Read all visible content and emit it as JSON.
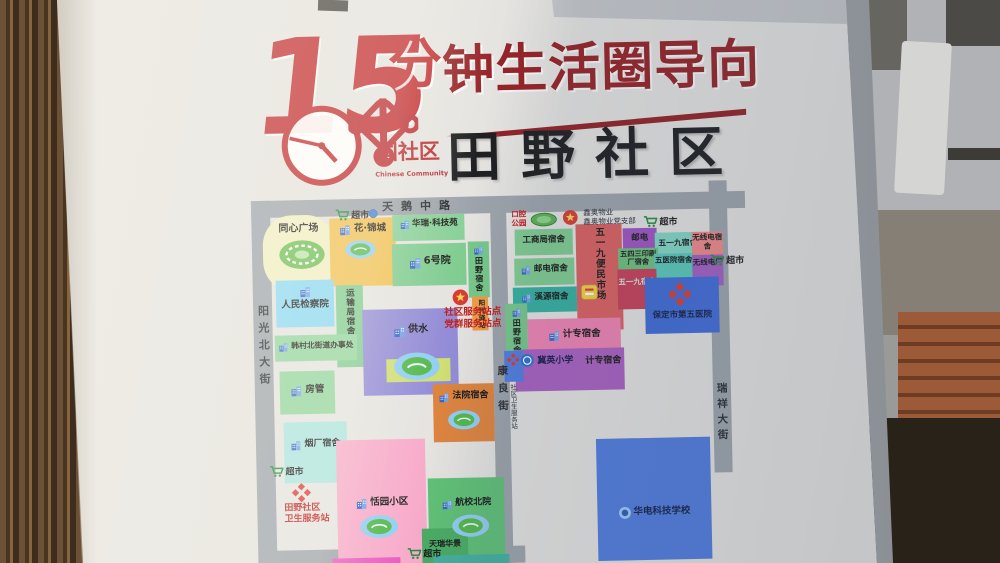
{
  "header": {
    "title_number": "15",
    "title_fen": "分",
    "title_rest": "钟生活圈导向",
    "logo_text": "国社区",
    "logo_subtext": "Chinese Community",
    "community_name": "田野社区"
  },
  "colors": {
    "title_red": "#bf2428",
    "title_maroon": "#931c20",
    "annotation_red": "#c01818",
    "road_gray": "#9aa1a9"
  },
  "map": {
    "roads": [
      {
        "id": "tiane-middle-road",
        "x": 253,
        "y": 196,
        "w": 494,
        "h": 17
      },
      {
        "id": "yangguang-north-street-road",
        "x": 253,
        "y": 196,
        "w": 19,
        "h": 367
      },
      {
        "id": "kangliang-street-road",
        "x": 492,
        "y": 207,
        "w": 16,
        "h": 356
      },
      {
        "id": "ruixiang-street-road",
        "x": 711,
        "y": 185,
        "w": 18,
        "h": 292
      },
      {
        "id": "south-road",
        "x": 258,
        "y": 546,
        "w": 262,
        "h": 17
      }
    ],
    "road_labels": [
      {
        "id": "tiane-middle-road-label",
        "t": "天鹅中路",
        "x": 384,
        "y": 198,
        "fs": 11,
        "ls": 8
      },
      {
        "id": "yangguang-north-street-label",
        "t": "阳光北大街",
        "x": 256,
        "y": 300,
        "fs": 11,
        "ls": 6,
        "v": 1
      },
      {
        "id": "kangliang-street-label",
        "t": "康良街",
        "x": 494,
        "y": 365,
        "fs": 10.5,
        "ls": 7,
        "v": 1
      },
      {
        "id": "ruixiang-street-label",
        "t": "瑞祥大街",
        "x": 713,
        "y": 387,
        "fs": 10.5,
        "ls": 5,
        "v": 1
      }
    ],
    "areas": [
      {
        "id": "tongxin-square",
        "t": "同心广场",
        "x": 264,
        "y": 211,
        "w": 72,
        "h": 76,
        "bg": "#f0eec2",
        "fs": 10,
        "ly": 8,
        "round": 40
      },
      {
        "id": "hua-jincheng",
        "t": "花·锦城",
        "x": 331,
        "y": 215,
        "w": 66,
        "h": 68,
        "bg": "#f0bf4e",
        "fs": 9.5,
        "icon": "building",
        "ly": 5
      },
      {
        "id": "huarui-tech-park",
        "t": "华瑞·科技苑",
        "x": 394,
        "y": 213,
        "w": 72,
        "h": 26,
        "bg": "#85cf96",
        "fs": 8.5,
        "icon": "building",
        "ly": 4
      },
      {
        "id": "no6-yard",
        "t": "6号院",
        "x": 393,
        "y": 242,
        "w": 74,
        "h": 42,
        "bg": "#7ccb8e",
        "fs": 10,
        "icon": "building",
        "ly": 12
      },
      {
        "id": "tianye-dorm-west",
        "t": "田野宿舍",
        "x": 469,
        "y": 241,
        "w": 21,
        "h": 56,
        "bg": "#72c787",
        "fs": 8,
        "icon": "building",
        "v": 1
      },
      {
        "id": "peoples-procuratorate",
        "t": "人民检察院",
        "x": 276,
        "y": 276,
        "w": 58,
        "h": 47,
        "bg": "#86d8f4",
        "fs": 9.5,
        "icon": "building",
        "col": 1,
        "ly": 5
      },
      {
        "id": "transport-bureau-dorm",
        "t": "运输局宿舍",
        "x": 336,
        "y": 282,
        "w": 27,
        "h": 82,
        "bg": "#7ccb8e",
        "fs": 8.5,
        "v": 1
      },
      {
        "id": "water-supply",
        "t": "供水",
        "x": 362,
        "y": 307,
        "w": 95,
        "h": 86,
        "bg": "#9089d6",
        "fs": 10,
        "icon": "building",
        "ly": 15
      },
      {
        "id": "hancun-north-street-office",
        "t": "韩村北街道办事处",
        "x": 274,
        "y": 331,
        "w": 82,
        "h": 26,
        "bg": "#8fd49b",
        "fs": 7.8,
        "icon": "building",
        "ly": 6
      },
      {
        "id": "housing-authority",
        "t": "房管",
        "x": 278,
        "y": 367,
        "w": 55,
        "h": 43,
        "bg": "#8fd49b",
        "fs": 9.5,
        "icon": "building",
        "ly": 13
      },
      {
        "id": "design-institute",
        "t": "设计院",
        "x": 385,
        "y": 357,
        "w": 64,
        "h": 23,
        "bg": "#cfdd70",
        "fs": 9,
        "icon": "building",
        "ly": 3
      },
      {
        "id": "court-dorm",
        "t": "法院宿舍",
        "x": 431,
        "y": 383,
        "w": 61,
        "h": 58,
        "bg": "#dd8038",
        "fs": 9,
        "icon": "building",
        "ly": 7
      },
      {
        "id": "tobacco-factory-dorm",
        "t": "烟厂宿舍",
        "x": 281,
        "y": 418,
        "w": 63,
        "h": 61,
        "bg": "#a8e4de",
        "fs": 9,
        "icon": "building",
        "ly": 17
      },
      {
        "id": "tianyuan-community",
        "t": "恬园小区",
        "x": 333,
        "y": 437,
        "w": 89,
        "h": 125,
        "bg": "#f7a9c9",
        "fs": 9.5,
        "icon": "building",
        "ly": 57
      },
      {
        "id": "hangxiao-north-yard",
        "t": "航校北院",
        "x": 424,
        "y": 477,
        "w": 76,
        "h": 86,
        "bg": "#5bbf72",
        "fs": 9,
        "icon": "building",
        "ly": 20
      },
      {
        "id": "tianrui-huajing",
        "t": "天瑞华景",
        "x": 417,
        "y": 527,
        "w": 46,
        "h": 35,
        "bg": "#45aa60",
        "fs": 8,
        "ly": 11
      },
      {
        "id": "gongshang-bureau-dorm",
        "t": "工商局宿舍",
        "x": 516,
        "y": 230,
        "w": 58,
        "h": 26,
        "bg": "#7ccb8e",
        "fs": 8.5,
        "ly": 6
      },
      {
        "id": "post-telecom-dorm",
        "t": "邮电宿舍",
        "x": 515,
        "y": 259,
        "w": 60,
        "h": 27,
        "bg": "#7ccb8e",
        "fs": 8.5,
        "icon": "building",
        "ly": 6
      },
      {
        "id": "xiyuan-dorm",
        "t": "溪源宿舍",
        "x": 513,
        "y": 288,
        "w": 64,
        "h": 25,
        "bg": "#2fae9e",
        "fs": 8.5,
        "icon": "building",
        "ly": 5
      },
      {
        "id": "wuyijiu-market",
        "t": "五一九便民市场",
        "x": 577,
        "y": 226,
        "w": 46,
        "h": 106,
        "bg": "#d95b5b",
        "fs": 9.5,
        "v": 1
      },
      {
        "id": "post-telecom",
        "t": "邮电",
        "x": 624,
        "y": 231,
        "w": 34,
        "h": 25,
        "bg": "#9c4fc0",
        "fs": 8.5,
        "ly": 5
      },
      {
        "id": "wuyijiu-dorm",
        "t": "五一九宿舍",
        "x": 656,
        "y": 236,
        "w": 46,
        "h": 24,
        "bg": "#7fd6c4",
        "fs": 7.8,
        "ly": 6
      },
      {
        "id": "radio-dorm",
        "t": "无线电宿舍",
        "x": 693,
        "y": 236,
        "w": 31,
        "h": 33,
        "bg": "#ef8585",
        "fs": 7.5,
        "ly": 2
      },
      {
        "id": "wusansan-print-dorm",
        "t": "五四三印刷厂宿舍",
        "x": 619,
        "y": 251,
        "w": 40,
        "h": 38,
        "bg": "#6abf7a",
        "fs": 7.2,
        "ly": 2
      },
      {
        "id": "fifth-hospital-dorm",
        "t": "五医院宿舍",
        "x": 655,
        "y": 257,
        "w": 39,
        "h": 29,
        "bg": "#55c8b8",
        "fs": 7.5,
        "ly": 3
      },
      {
        "id": "radio-factory",
        "t": "无线电厂",
        "x": 693,
        "y": 259,
        "w": 31,
        "h": 31,
        "bg": "#a05ac2",
        "fs": 7.5,
        "ly": 4
      },
      {
        "id": "wuyijiu-dorm-2",
        "t": "五一九宿舍",
        "x": 618,
        "y": 272,
        "w": 39,
        "h": 40,
        "bg": "#c43a52",
        "fs": 7.5,
        "c": "#cdeedd",
        "ly": 9
      },
      {
        "id": "baoding-fifth-hospital",
        "t": "保定市第五医院",
        "x": 645,
        "y": 281,
        "w": 74,
        "h": 56,
        "bg": "#3a66d6",
        "fs": 8.5,
        "c": "#0e1b42",
        "ly": 33
      },
      {
        "id": "tianye-dorm-east",
        "t": "田野宿舍",
        "x": 505,
        "y": 304,
        "w": 22,
        "h": 48,
        "bg": "#72c787",
        "fs": 8,
        "icon": "building",
        "v": 1
      },
      {
        "id": "jizhuan-dorm",
        "t": "计专宿舍",
        "x": 527,
        "y": 320,
        "w": 93,
        "h": 37,
        "bg": "#ef7fb2",
        "fs": 9.5,
        "icon": "building",
        "ly": 10
      },
      {
        "id": "jiying-primary-school",
        "t": "",
        "x": 514,
        "y": 350,
        "w": 109,
        "h": 42,
        "bg": "#a65bbf"
      },
      {
        "id": "clinic-point",
        "t": "",
        "x": 503,
        "y": 351,
        "w": 19,
        "h": 31,
        "bg": "#4a7ae0"
      },
      {
        "id": "huadian-tech-school",
        "t": "华电科技学校",
        "x": 593,
        "y": 441,
        "w": 114,
        "h": 122,
        "bg": "#4a78dd",
        "fs": 9.5,
        "icon": "circle",
        "c": "#0e1b42",
        "ly": 68
      },
      {
        "id": "sunshine-post",
        "t": "阳光驿站",
        "x": 472,
        "y": 296,
        "w": 16,
        "h": 34,
        "bg": "#f09a3e",
        "fs": 6.5,
        "v": 1
      },
      {
        "id": "south-strip-magenta",
        "t": "",
        "x": 327,
        "y": 555,
        "w": 68,
        "h": 8,
        "bg": "#e957c0"
      },
      {
        "id": "south-strip-teal",
        "t": "",
        "x": 428,
        "y": 554,
        "w": 76,
        "h": 9,
        "bg": "#3fae9c"
      }
    ],
    "annotations": [
      {
        "id": "service-station-caption",
        "lines": [
          "社区服务站点",
          "党群服务站点"
        ],
        "x": 444,
        "y": 306,
        "fs": 9.5,
        "c": "#c01818",
        "b": 1
      },
      {
        "id": "tianye-health-station-caption",
        "lines": [
          "田野社区",
          "卫生服务站"
        ],
        "x": 280,
        "y": 499,
        "fs": 9,
        "c": "#c01818",
        "b": 1
      },
      {
        "id": "dental-park-caption",
        "lines": [
          "口腔",
          "公园"
        ],
        "x": 513,
        "y": 210,
        "fs": 7.5,
        "c": "#c01818",
        "b": 1
      },
      {
        "id": "property-caption",
        "lines": [
          "鑫奥物业",
          "鑫奥物业党支部"
        ],
        "x": 585,
        "y": 210,
        "fs": 7.5,
        "c": "#1c2430"
      },
      {
        "id": "clinic-point-caption",
        "lines": [
          "社区卫生服务站"
        ],
        "x": 506,
        "y": 384,
        "fs": 6.5,
        "c": "#1c2430",
        "v": 1
      },
      {
        "id": "jiying-school-label",
        "lines": [
          "冀英小学"
        ],
        "x": 536,
        "y": 357,
        "fs": 9,
        "c": "#101742",
        "b": 1
      },
      {
        "id": "jizhuan-dorm-label-2",
        "lines": [
          "计专宿舍"
        ],
        "x": 584,
        "y": 358,
        "fs": 9,
        "c": "#141414",
        "b": 1
      }
    ],
    "markers": [
      {
        "id": "supermarket-nw",
        "icon": "cart",
        "x": 337,
        "y": 204,
        "s": 14,
        "t": "超市",
        "fs": 9
      },
      {
        "id": "poi-dot",
        "icon": "dot",
        "x": 370,
        "y": 206,
        "s": 10
      },
      {
        "id": "supermarket-ne",
        "icon": "cart",
        "x": 645,
        "y": 217,
        "s": 14,
        "t": "超市",
        "fs": 9
      },
      {
        "id": "supermarket-e",
        "icon": "cart",
        "x": 711,
        "y": 257,
        "s": 14,
        "t": "超市",
        "fs": 9
      },
      {
        "id": "supermarket-w",
        "icon": "cart",
        "x": 266,
        "y": 459,
        "s": 14,
        "t": "超市",
        "fs": 9
      },
      {
        "id": "supermarket-s",
        "icon": "cart",
        "x": 402,
        "y": 544,
        "s": 14,
        "t": "超市",
        "fs": 9
      },
      {
        "id": "party-emblem-west",
        "icon": "party",
        "x": 452,
        "y": 288,
        "s": 17
      },
      {
        "id": "party-emblem-north",
        "icon": "party",
        "x": 564,
        "y": 211,
        "s": 16
      },
      {
        "id": "park-oval",
        "icon": "park",
        "x": 532,
        "y": 213,
        "s": 27
      },
      {
        "id": "pond-huajincheng",
        "icon": "pond",
        "x": 346,
        "y": 237,
        "s": 31
      },
      {
        "id": "pond-water-supply",
        "icon": "pond",
        "x": 392,
        "y": 350,
        "s": 47
      },
      {
        "id": "pond-court",
        "icon": "pond",
        "x": 445,
        "y": 409,
        "s": 33
      },
      {
        "id": "pond-tianyuan",
        "icon": "pond",
        "x": 355,
        "y": 512,
        "s": 39
      },
      {
        "id": "pond-hangxiao",
        "icon": "pond",
        "x": 447,
        "y": 513,
        "s": 38
      },
      {
        "id": "stadium-oval",
        "icon": "stadium",
        "x": 279,
        "y": 235,
        "s": 48
      },
      {
        "id": "health-station-cross",
        "icon": "cross",
        "x": 287,
        "y": 478,
        "s": 21
      },
      {
        "id": "fifth-hospital-logo",
        "icon": "cross",
        "x": 667,
        "y": 285,
        "s": 26
      },
      {
        "id": "clinic-point-cross",
        "icon": "cross",
        "x": 505,
        "y": 353,
        "s": 14
      },
      {
        "id": "jiying-school-icon",
        "icon": "school",
        "x": 519,
        "y": 354,
        "s": 14
      },
      {
        "id": "market-badge",
        "icon": "badge",
        "x": 581,
        "y": 286,
        "s": 17
      }
    ]
  }
}
